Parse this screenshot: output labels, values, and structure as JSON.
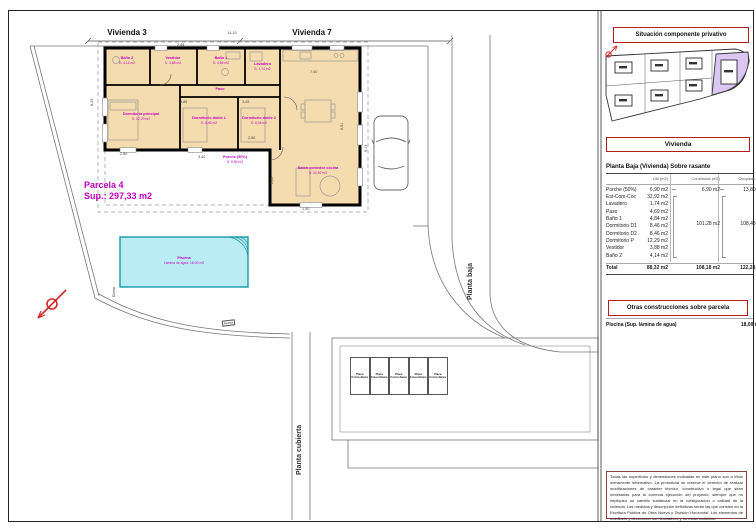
{
  "plan": {
    "top_labels": {
      "vivienda3": "Vivienda 3",
      "vivienda7": "Vivienda 7"
    },
    "parcela": {
      "title": "Parcela 4",
      "sup": "Sup.: 297,33 m2"
    },
    "rooms": [
      {
        "name": "Baño 2",
        "area": "S: 4,14 m2"
      },
      {
        "name": "Vestidor",
        "area": "S: 3,88 m2"
      },
      {
        "name": "Baño 1",
        "area": "S: 4,84 m2"
      },
      {
        "name": "Lavadero",
        "area": "S: 1,74 m2"
      },
      {
        "name": "Paso",
        "area": "S: 4,69 m2"
      },
      {
        "name": "Dormitorio principal",
        "area": "S: 12,29 m2"
      },
      {
        "name": "Dormitorio doble 1",
        "area": "S: 8,46 m2"
      },
      {
        "name": "Dormitorio doble 2",
        "area": "S: 8,46 m2"
      },
      {
        "name": "Salón comedor cocina",
        "area": "S: 32,92 m2"
      },
      {
        "name": "Porche (50%)",
        "area": "S: 6,90 m2"
      }
    ],
    "pool": {
      "name": "Piscina",
      "area": "Lámina de agua: 18,00 m2"
    },
    "dims": [
      "14,10",
      "8,29",
      "9,13",
      "2,80",
      "3,40",
      "3,85",
      "3,45",
      "2,85",
      "7,40",
      "8,51",
      "2,60",
      "1,50",
      "2,44"
    ],
    "strips": {
      "planta_baja": "Planta baja",
      "planta_cubierta": "Planta cubierta"
    },
    "misc": {
      "ducha": "Ducha",
      "acera": "Acera"
    },
    "solar_panel": {
      "line1": "Placa",
      "line2": "Fotovoltaica",
      "count": 5
    }
  },
  "panel": {
    "situacion_title": "Situación componente privativo",
    "vivienda_title": "Vivienda",
    "table": {
      "title": "Planta Baja (Vivienda) Sobre rasante",
      "columns": [
        "Útil (m2)",
        "Construida (m2)",
        "Ocupada (m2)"
      ],
      "rows": [
        {
          "label": "Porche (50%)",
          "util": "6,90 m2",
          "construida": "6,90 m2",
          "ocupada": "13,80 m2"
        },
        {
          "label": "Est-Com-Coc",
          "util": "32,92 m2",
          "construida": "",
          "ocupada": ""
        },
        {
          "label": "Lavadero",
          "util": "1,74 m2",
          "construida": "",
          "ocupada": ""
        },
        {
          "label": "Paso",
          "util": "4,69 m2",
          "construida": "",
          "ocupada": ""
        },
        {
          "label": "Baño 1",
          "util": "4,84 m2",
          "construida": "",
          "ocupada": ""
        },
        {
          "label": "Dormitorio D1",
          "util": "8,46 m2",
          "construida": "",
          "ocupada": ""
        },
        {
          "label": "Dormitorio D2",
          "util": "8,46 m2",
          "construida": "",
          "ocupada": ""
        },
        {
          "label": "Dormitorio P",
          "util": "12,29 m2",
          "construida": "",
          "ocupada": ""
        },
        {
          "label": "Vestidor",
          "util": "3,88 m2",
          "construida": "",
          "ocupada": ""
        },
        {
          "label": "Baño 2",
          "util": "4,14 m2",
          "construida": "",
          "ocupada": ""
        }
      ],
      "group": {
        "construida": "101,28 m2",
        "ocupada": "108,48 m2"
      },
      "total": {
        "label": "Total",
        "util": "88,32 m2",
        "construida": "108,18 m2",
        "ocupada": "122,28 m2"
      }
    },
    "otras_title": "Otras construcciones sobre parcela",
    "piscina": {
      "label": "Piscina (Sup. lámina de agua)",
      "value": "18,00 m2"
    },
    "legal": "Todas las superficies y dimensiones indicadas en este plano son a título meramente informativo. La promotora se reserva el derecho de realizar modificaciones de carácter técnico, constructivo o legal que sean necesarias para la correcta ejecución del proyecto, siempre que no impliquen un cambio sustancial en la configuración o calidad de la vivienda. Las medidas y descripción definitivas serán las que consten en la Escritura Pública de Obra Nueva y División Horizontal. Los elementos de mobiliario y decoración son ilustrativos y no están incluidos."
  }
}
